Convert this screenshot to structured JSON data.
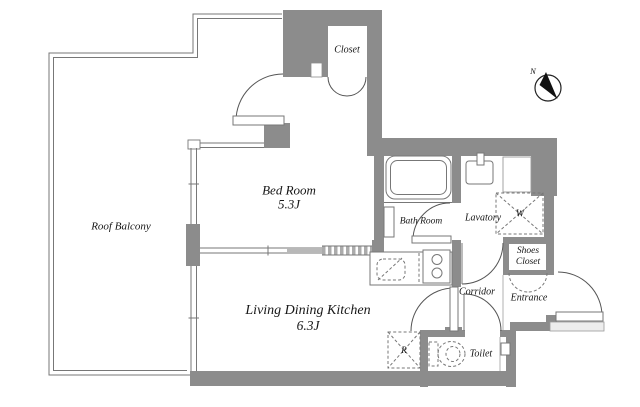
{
  "plan": {
    "compass": {
      "north": "N"
    },
    "rooms": {
      "roof_balcony": "Roof Balcony",
      "bed_room_name": "Bed Room",
      "bed_room_size": "5.3J",
      "ldk_name": "Living Dining Kitchen",
      "ldk_size": "6.3J",
      "bath_room": "Bath Room",
      "lavatory": "Lavatory",
      "closet": "Closet",
      "shoes_closet": "Shoes Closet",
      "corridor": "Corridor",
      "entrance": "Entrance",
      "toilet": "Toilet"
    },
    "fixtures": {
      "washer": "W",
      "refrigerator": "R"
    },
    "colors": {
      "wall": "#8c8c8c",
      "line": "#777777",
      "text": "#161616"
    }
  }
}
